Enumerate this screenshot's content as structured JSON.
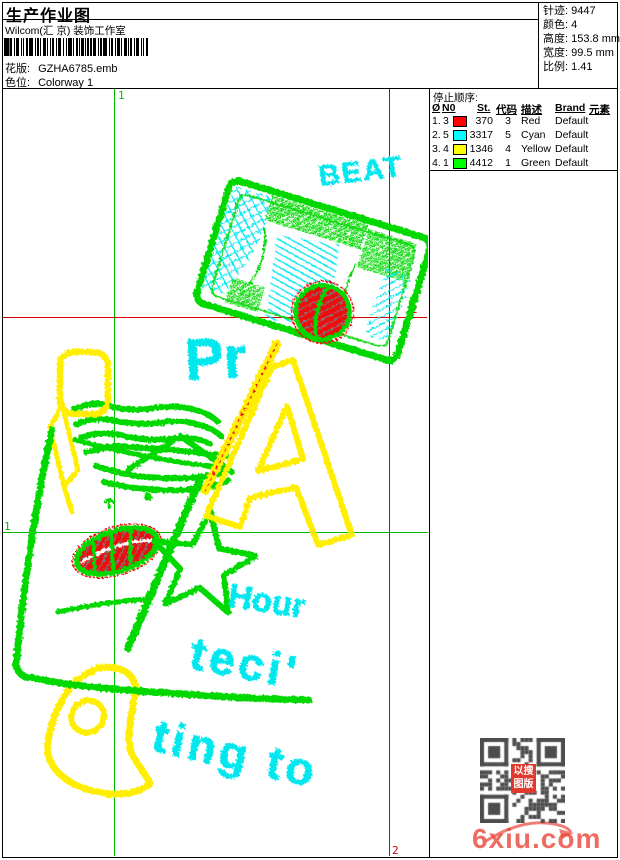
{
  "header": {
    "title": "生产作业图",
    "company": "Wilcom(汇 京) 装饰工作室",
    "pattern_label": "花版:",
    "pattern_value": "GZHA6785.emb",
    "colorway_label": "色位:",
    "colorway_value": "Colorway 1"
  },
  "info_panel": {
    "rows": [
      {
        "label": "针迹:",
        "value": "9447"
      },
      {
        "label": "颜色:",
        "value": "4"
      },
      {
        "label": "高度:",
        "value": "153.8 mm"
      },
      {
        "label": "宽度:",
        "value": "99.5 mm"
      },
      {
        "label": "比例:",
        "value": "1.41"
      }
    ]
  },
  "stop_sequence": {
    "title": "停止顺序:",
    "columns": [
      "Ø",
      "N0",
      "St.",
      "代码",
      "描述",
      "Brand",
      "元素"
    ],
    "rows": [
      {
        "idx": "1.",
        "needle": "3",
        "color": "#ff0000",
        "stitches": "370",
        "code": "3",
        "description": "Red",
        "brand": "Default"
      },
      {
        "idx": "2.",
        "needle": "5",
        "color": "#00ffff",
        "stitches": "3317",
        "code": "5",
        "description": "Cyan",
        "brand": "Default"
      },
      {
        "idx": "3.",
        "needle": "4",
        "color": "#ffff00",
        "stitches": "1346",
        "code": "4",
        "description": "Yellow",
        "brand": "Default"
      },
      {
        "idx": "4.",
        "needle": "1",
        "color": "#00ff00",
        "stitches": "4412",
        "code": "1",
        "description": "Green",
        "brand": "Default"
      }
    ]
  },
  "design": {
    "markers": {
      "start": "1",
      "end": "2"
    },
    "stitch_texts": {
      "beat": "BEAT",
      "pr": "Pr",
      "hour": "Hour",
      "teci": "teci'",
      "ting_to": "ting to"
    },
    "palette": {
      "green": "#00d800",
      "cyan": "#00e8ee",
      "yellow": "#ffee00",
      "red": "#ee1111"
    }
  },
  "watermark": {
    "logo": "6xiu.com",
    "stamp_line1": "以搜",
    "stamp_line2": "图版"
  }
}
